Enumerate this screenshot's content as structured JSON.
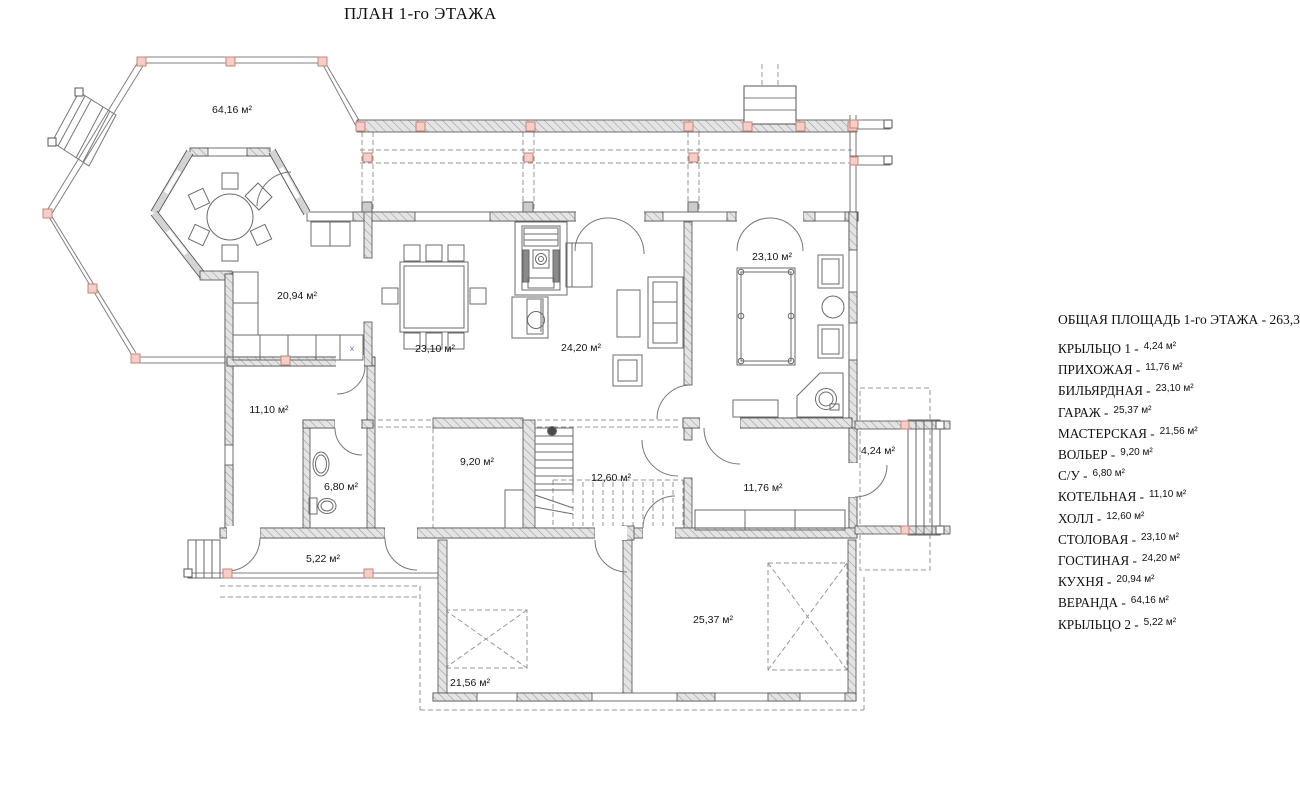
{
  "title": "ПЛАН 1-го ЭТАЖА",
  "colors": {
    "post_pink": "#f6cec7",
    "post_pink_border": "#c5857a",
    "wall_fill": "#e4e4e4",
    "wall_hatch": "#999999",
    "line_dark": "#4f4f4f",
    "line_thin": "#808080",
    "dash_gray": "#979797",
    "label_text": "#141414",
    "marker_blue": "#5b74e8"
  },
  "plan": {
    "marker_x": "x",
    "rooms": [
      {
        "id": "veranda",
        "label": "64,16 м²"
      },
      {
        "id": "kitchen",
        "label": "20,94 м²"
      },
      {
        "id": "dining",
        "label": "23,10 м²"
      },
      {
        "id": "living",
        "label": "24,20 м²"
      },
      {
        "id": "billiard",
        "label": "23,10 м²"
      },
      {
        "id": "boiler",
        "label": "11,10 м²"
      },
      {
        "id": "bathroom",
        "label": "6,80 м²"
      },
      {
        "id": "kennel",
        "label": "9,20 м²"
      },
      {
        "id": "hall",
        "label": "12,60 м²"
      },
      {
        "id": "hallway",
        "label": "11,76 м²"
      },
      {
        "id": "porch1",
        "label": "4,24 м²"
      },
      {
        "id": "porch2",
        "label": "5,22 м²"
      },
      {
        "id": "garage",
        "label": "25,37 м²"
      },
      {
        "id": "workshop",
        "label": "21,56 м²"
      }
    ]
  },
  "legend": {
    "title_label": "ОБЩАЯ ПЛОЩАДЬ 1-го ЭТАЖА -",
    "title_value": "263,35 м²",
    "items": [
      {
        "name": "КРЫЛЬЦО 1 -",
        "value": "4,24 м²"
      },
      {
        "name": "ПРИХОЖАЯ -",
        "value": "11,76 м²"
      },
      {
        "name": "БИЛЬЯРДНАЯ -",
        "value": "23,10 м²"
      },
      {
        "name": "ГАРАЖ -",
        "value": "25,37 м²"
      },
      {
        "name": "МАСТЕРСКАЯ -",
        "value": "21,56 м²"
      },
      {
        "name": "ВОЛЬЕР -",
        "value": "9,20 м²"
      },
      {
        "name": "С/У -",
        "value": "6,80 м²"
      },
      {
        "name": "КОТЕЛЬНАЯ -",
        "value": "11,10 м²"
      },
      {
        "name": "ХОЛЛ -",
        "value": "12,60 м²"
      },
      {
        "name": "СТОЛОВАЯ -",
        "value": "23,10 м²"
      },
      {
        "name": "ГОСТИНАЯ -",
        "value": "24,20 м²"
      },
      {
        "name": "КУХНЯ -",
        "value": "20,94 м²"
      },
      {
        "name": "ВЕРАНДА -",
        "value": "64,16 м²"
      },
      {
        "name": "КРЫЛЬЦО 2 -",
        "value": "5,22 м²"
      }
    ]
  }
}
